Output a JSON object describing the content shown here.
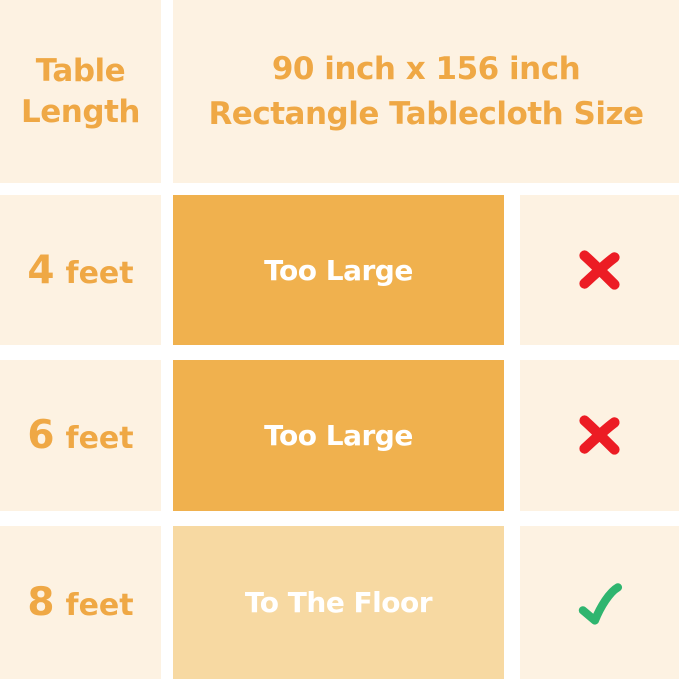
{
  "chart_data": {
    "type": "table",
    "title": "90 inch x 156 inch Rectangle Tablecloth Size",
    "columns": [
      "Table Length",
      "90 inch x 156 inch Rectangle Tablecloth Size",
      "Suitability"
    ],
    "rows": [
      {
        "table_length": "4 feet",
        "fit": "Too Large",
        "suitable": false
      },
      {
        "table_length": "6 feet",
        "fit": "Too Large",
        "suitable": false
      },
      {
        "table_length": "8 feet",
        "fit": "To The Floor",
        "suitable": true
      }
    ]
  },
  "header": {
    "left_line1": "Table",
    "left_line2": "Length",
    "right_line1": "90 inch x 156 inch",
    "right_line2": "Rectangle Tablecloth Size"
  },
  "rows": [
    {
      "length_number": "4",
      "length_unit": "feet",
      "fit_label": "Too Large",
      "status_icon": "x-mark"
    },
    {
      "length_number": "6",
      "length_unit": "feet",
      "fit_label": "Too Large",
      "status_icon": "x-mark"
    },
    {
      "length_number": "8",
      "length_unit": "feet",
      "fit_label": "To The Floor",
      "status_icon": "check-mark"
    }
  ],
  "colors": {
    "background_cream": "#FDF2E2",
    "gap_white": "#FFFFFF",
    "accent_orange_text": "#EFA845",
    "block_orange": "#F0B14E",
    "block_light_tan": "#F7D9A2",
    "x_mark_red": "#EC1C24",
    "check_mark_green": "#2FB56F",
    "block_text_white": "#FFFFFF"
  }
}
